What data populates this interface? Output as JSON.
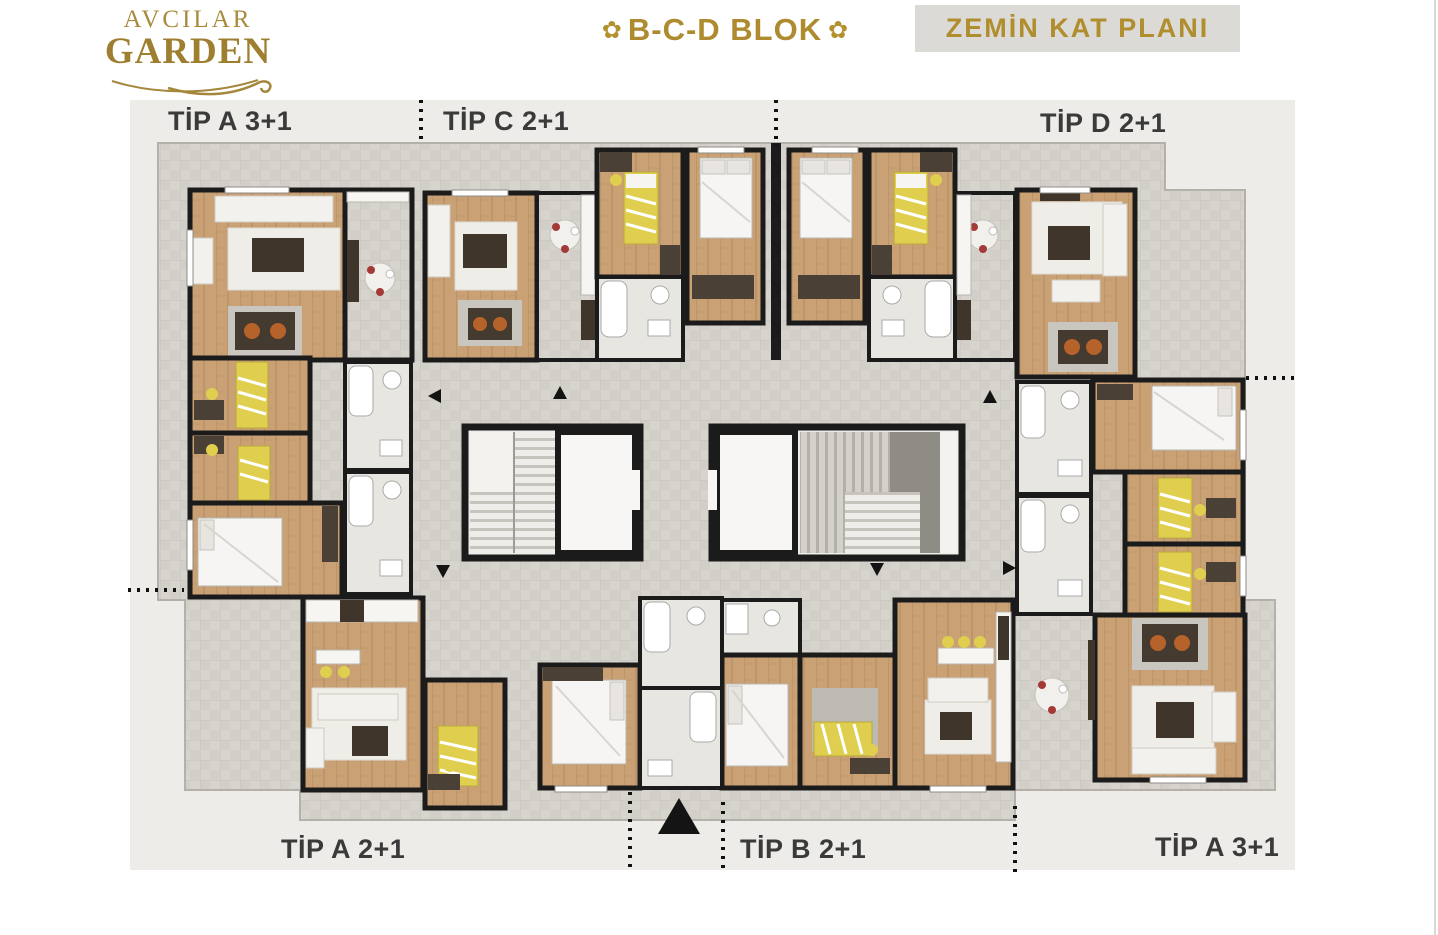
{
  "header": {
    "logo": {
      "line1": "AVCILAR",
      "line2": "GARDEN"
    },
    "block": {
      "title": "B-C-D BLOK",
      "ornament": "✿"
    },
    "plan_title": "ZEMİN KAT PLANI"
  },
  "unit_labels": {
    "top_left": "TİP A 3+1",
    "top_center": "TİP C 2+1",
    "top_right": "TİP D 2+1",
    "bottom_left": "TİP A 2+1",
    "bottom_center": "TİP B 2+1",
    "bottom_right": "TİP A 3+1"
  },
  "icons": {
    "north_arrow": "north-arrow",
    "direction_arrow": "direction-arrow",
    "logo_flourish": "logo-flourish-icon"
  },
  "colors": {
    "gold": "#A6862F",
    "label_text": "#3A3A3A",
    "board": "#EDECE9",
    "tile": "#D6D3CD",
    "wood": "#C8A077",
    "wall": "#1B1B1B",
    "bath": "#E8E6E1",
    "accent_yellow": "#E0CE4F",
    "seat_orange": "#B5632A"
  }
}
